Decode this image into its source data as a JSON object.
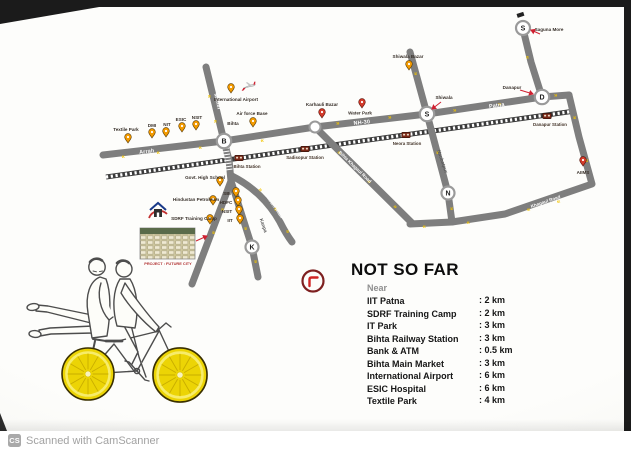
{
  "colors": {
    "road": "#7e7e7e",
    "rail": "#3b3b3b",
    "arrow_yellow": "#f2c400",
    "accent_red": "#cf2030",
    "lemon_yellow": "#ecd405",
    "page_white": "#fdfdfb",
    "footer_gray": "#a2a2a2"
  },
  "map": {
    "arrow": "»",
    "roads": {
      "arrah": "Arrah",
      "maner": "Maner",
      "nh30": "NH-30",
      "patna": "Patna",
      "naubatpur": "Naubatpur",
      "kanpa": "Kanpa",
      "bikram": "Bikram Road",
      "bihta_khagaul": "Bihta Khagaul Road",
      "khagaul": "Khagaul Road"
    },
    "junctions": {
      "bihta": "B",
      "shiwala": "S",
      "danapur": "D",
      "naubatpur": "N",
      "kanpa": "K",
      "saguna": "S"
    },
    "places": {
      "textile_park": "Textile Park",
      "dmi": "DMI",
      "nit": "NIT",
      "esic": "ESIC",
      "nsit": "NSIT",
      "air_force_base": "Air force Base",
      "international_airport": "International Airport",
      "karhauli_bazar": "Karhauli Bazar",
      "water_park": "Water Park",
      "shiwala": "Shiwala",
      "shiwala_bazar": "Shiwala Bazar",
      "saguna_more": "Saguna More",
      "danapur": "Danapur",
      "aiims": "AIIMS",
      "bihta": "Bihta",
      "govt_high_school": "Govt. High School",
      "hindustan_petroleum": "Hindustan Petroleum",
      "sdrf_camp": "SDRF Training Camp",
      "sbi": "SBI",
      "hdfc": "HDFC",
      "nsit_kanpa": "NSIT",
      "iit": "IIT"
    },
    "stations": {
      "bihta": "Bihta Station",
      "sadisopur": "Sadisopur Station",
      "neora": "Neora Station",
      "danapur": "Danapur Station"
    },
    "inset_caption": "PROJECT : FUTURE CITY"
  },
  "distances": {
    "title": "NOT SO FAR",
    "subtitle": "Near",
    "items": [
      {
        "label": "IIT Patna",
        "value": ": 2 km"
      },
      {
        "label": "SDRF Training Camp",
        "value": ": 2 km"
      },
      {
        "label": "IT Park",
        "value": ": 3 km"
      },
      {
        "label": "Bihta Railway Station",
        "value": ": 3 km"
      },
      {
        "label": "Bank & ATM",
        "value": ": 0.5 km"
      },
      {
        "label": "Bihta Main Market",
        "value": ": 3 km"
      },
      {
        "label": "International Airport",
        "value": ": 6 km"
      },
      {
        "label": "ESIC Hospital",
        "value": ": 6 km"
      },
      {
        "label": "Textile Park",
        "value": ": 4 km"
      }
    ]
  },
  "footer": {
    "badge": "CS",
    "text": "Scanned with CamScanner"
  }
}
